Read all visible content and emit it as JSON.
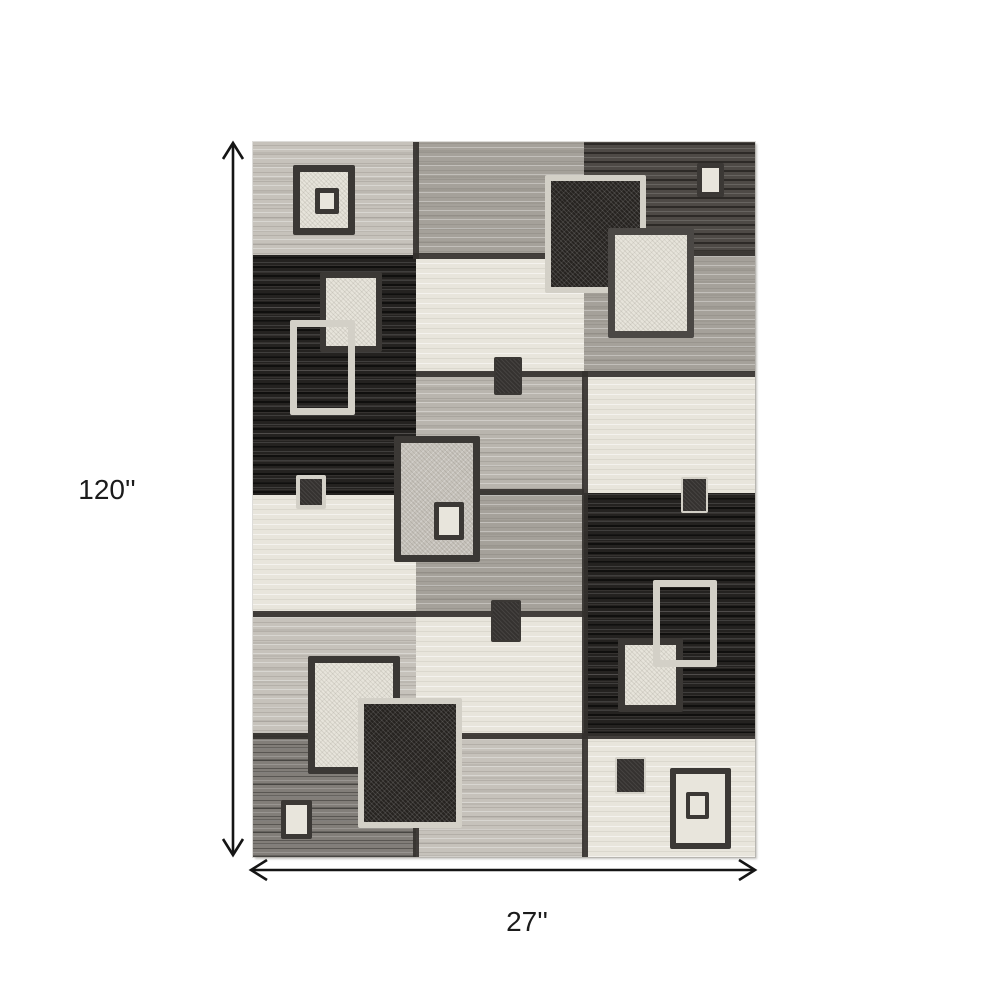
{
  "figure": {
    "height_label": "120''",
    "width_label": "27''"
  },
  "palette": {
    "background": "#ffffff",
    "text": "#1b1b1b",
    "arrow": "#151515",
    "seam": "#34312e",
    "border_dark": "#3b3835",
    "border_gray": "#4b4845",
    "border_light": "#d3d0c7",
    "cream": "#e8e5dc",
    "lightgray": "#c6c2bb",
    "greige": "#b9b5ae",
    "midgray": "#a5a19a",
    "charcoal": "#4e4a46",
    "medgray": "#827e79",
    "black": "#242220"
  },
  "rug": {
    "width_px": 502,
    "height_px": 715,
    "panels": [
      {
        "name": "top-left-lightgray",
        "x": 0,
        "y": 0,
        "w": 165,
        "h": 116,
        "shade": "lightgray"
      },
      {
        "name": "left-black",
        "x": 0,
        "y": 113,
        "w": 165,
        "h": 242,
        "shade": "black"
      },
      {
        "name": "left-cream",
        "x": 0,
        "y": 353,
        "w": 165,
        "h": 120,
        "shade": "cream"
      },
      {
        "name": "left-lightgray-2",
        "x": 0,
        "y": 471,
        "w": 165,
        "h": 122,
        "shade": "lightgray"
      },
      {
        "name": "bottom-left-medgray",
        "x": 0,
        "y": 591,
        "w": 165,
        "h": 124,
        "shade": "medgray"
      },
      {
        "name": "top-center-midgray",
        "x": 163,
        "y": 0,
        "w": 170,
        "h": 114,
        "shade": "midgray"
      },
      {
        "name": "center-cream",
        "x": 163,
        "y": 112,
        "w": 170,
        "h": 120,
        "shade": "cream"
      },
      {
        "name": "center-greige",
        "x": 163,
        "y": 230,
        "w": 170,
        "h": 121,
        "shade": "greige"
      },
      {
        "name": "center-midgray",
        "x": 163,
        "y": 349,
        "w": 170,
        "h": 122,
        "shade": "midgray"
      },
      {
        "name": "center-cream-2",
        "x": 163,
        "y": 469,
        "w": 170,
        "h": 126,
        "shade": "cream"
      },
      {
        "name": "bottom-center-lightgray",
        "x": 163,
        "y": 593,
        "w": 170,
        "h": 122,
        "shade": "lightgray"
      },
      {
        "name": "top-right-charcoal",
        "x": 331,
        "y": 0,
        "w": 171,
        "h": 111,
        "shade": "charcoal"
      },
      {
        "name": "right-midgray",
        "x": 331,
        "y": 109,
        "w": 171,
        "h": 123,
        "shade": "midgray"
      },
      {
        "name": "right-cream",
        "x": 331,
        "y": 230,
        "w": 171,
        "h": 123,
        "shade": "cream"
      },
      {
        "name": "right-black",
        "x": 331,
        "y": 351,
        "w": 171,
        "h": 245,
        "shade": "black"
      },
      {
        "name": "bottom-right-cream",
        "x": 331,
        "y": 594,
        "w": 171,
        "h": 121,
        "shade": "cream"
      }
    ],
    "seams": [
      {
        "x": 160,
        "y": 0,
        "w": 6,
        "h": 117
      },
      {
        "x": 160,
        "y": 111,
        "w": 173,
        "h": 6
      },
      {
        "x": 331,
        "y": 108,
        "w": 171,
        "h": 6
      },
      {
        "x": 163,
        "y": 229,
        "w": 339,
        "h": 6
      },
      {
        "x": 329,
        "y": 229,
        "w": 6,
        "h": 242
      },
      {
        "x": 163,
        "y": 347,
        "w": 168,
        "h": 6
      },
      {
        "x": 0,
        "y": 469,
        "w": 333,
        "h": 6
      },
      {
        "x": 0,
        "y": 591,
        "w": 502,
        "h": 6
      },
      {
        "x": 329,
        "y": 471,
        "w": 6,
        "h": 244
      },
      {
        "x": 160,
        "y": 593,
        "w": 6,
        "h": 122
      }
    ],
    "motifs": [
      {
        "id": "tl-square",
        "x": 40,
        "y": 23,
        "w": 62,
        "h": 70,
        "bw": 7,
        "bc": "border_dark",
        "fill": "speckle-cream",
        "z": 3
      },
      {
        "id": "tl-square-inner",
        "x": 62,
        "y": 46,
        "w": 24,
        "h": 26,
        "bw": 5,
        "bc": "border_dark",
        "fill": "cream",
        "z": 4
      },
      {
        "id": "top-dark-square",
        "x": 292,
        "y": 33,
        "w": 101,
        "h": 118,
        "bw": 6,
        "bc": "border_light",
        "fill": "speckle-black",
        "z": 3
      },
      {
        "id": "top-cream-square",
        "x": 355,
        "y": 86,
        "w": 86,
        "h": 110,
        "bw": 7,
        "bc": "border_gray",
        "fill": "speckle-cream",
        "z": 4
      },
      {
        "id": "tr-small-cream",
        "x": 444,
        "y": 21,
        "w": 27,
        "h": 34,
        "bw": 5,
        "bc": "border_dark",
        "fill": "cream",
        "z": 3
      },
      {
        "id": "left-cream-square",
        "x": 67,
        "y": 130,
        "w": 62,
        "h": 80,
        "bw": 6,
        "bc": "border_dark",
        "fill": "speckle-cream",
        "z": 3
      },
      {
        "id": "left-outline-square",
        "x": 37,
        "y": 178,
        "w": 65,
        "h": 95,
        "bw": 7,
        "bc": "border_light",
        "fill": "none",
        "z": 4
      },
      {
        "id": "left-small-dark",
        "x": 43,
        "y": 333,
        "w": 30,
        "h": 34,
        "bw": 4,
        "bc": "border_light",
        "fill": "blackfill",
        "z": 3
      },
      {
        "id": "center-small-dark",
        "x": 241,
        "y": 215,
        "w": 28,
        "h": 38,
        "bw": 2,
        "bc": "border_dark",
        "fill": "blackfill",
        "z": 3
      },
      {
        "id": "center-big-square",
        "x": 141,
        "y": 294,
        "w": 86,
        "h": 126,
        "bw": 7,
        "bc": "border_dark",
        "fill": "speckle-greige",
        "z": 3
      },
      {
        "id": "center-big-inner",
        "x": 181,
        "y": 360,
        "w": 30,
        "h": 38,
        "bw": 5,
        "bc": "border_dark",
        "fill": "cream",
        "z": 4
      },
      {
        "id": "right-small-dark",
        "x": 428,
        "y": 335,
        "w": 27,
        "h": 36,
        "bw": 2,
        "bc": "border_light",
        "fill": "blackfill",
        "z": 3
      },
      {
        "id": "center-small-dark-2",
        "x": 238,
        "y": 458,
        "w": 30,
        "h": 42,
        "bw": 2,
        "bc": "border_dark",
        "fill": "blackfill",
        "z": 3
      },
      {
        "id": "right-cream-square",
        "x": 365,
        "y": 496,
        "w": 65,
        "h": 74,
        "bw": 7,
        "bc": "border_dark",
        "fill": "speckle-cream",
        "z": 3
      },
      {
        "id": "right-outline-square",
        "x": 400,
        "y": 438,
        "w": 64,
        "h": 87,
        "bw": 7,
        "bc": "border_light",
        "fill": "none",
        "z": 4
      },
      {
        "id": "bl-cream-square",
        "x": 55,
        "y": 514,
        "w": 92,
        "h": 118,
        "bw": 7,
        "bc": "border_dark",
        "fill": "speckle-cream",
        "z": 3
      },
      {
        "id": "bl-dark-square",
        "x": 105,
        "y": 556,
        "w": 104,
        "h": 130,
        "bw": 6,
        "bc": "border_light",
        "fill": "speckle-black",
        "z": 4
      },
      {
        "id": "bl-small-cream",
        "x": 28,
        "y": 658,
        "w": 31,
        "h": 39,
        "bw": 5,
        "bc": "border_dark",
        "fill": "cream",
        "z": 3
      },
      {
        "id": "br-small-dark",
        "x": 362,
        "y": 615,
        "w": 31,
        "h": 37,
        "bw": 2,
        "bc": "border_light",
        "fill": "blackfill",
        "z": 3
      },
      {
        "id": "br-square",
        "x": 417,
        "y": 626,
        "w": 61,
        "h": 81,
        "bw": 6,
        "bc": "border_dark",
        "fill": "cream",
        "z": 3
      },
      {
        "id": "br-square-inner",
        "x": 433,
        "y": 650,
        "w": 23,
        "h": 27,
        "bw": 4,
        "bc": "border_dark",
        "fill": "cream",
        "z": 4
      }
    ]
  }
}
